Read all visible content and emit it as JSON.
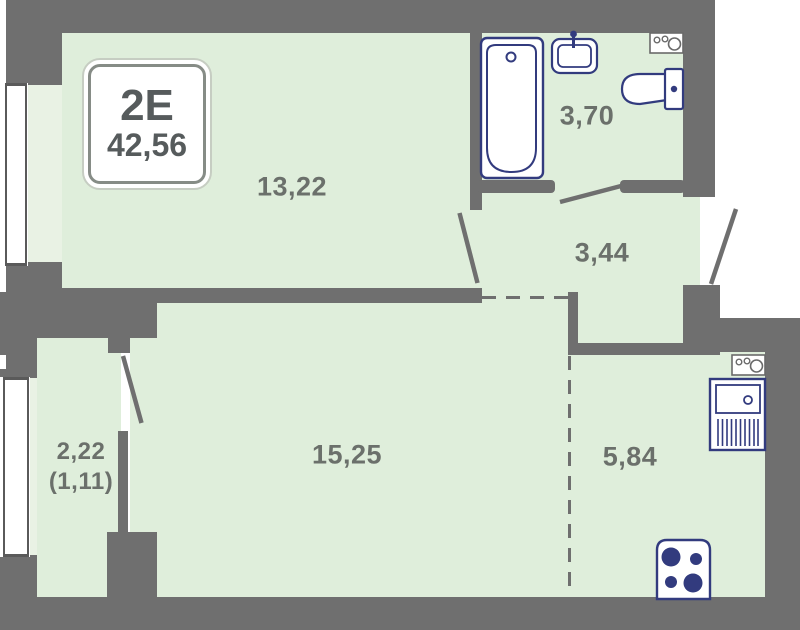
{
  "badge": {
    "unit_type": "2Е",
    "total_area": "42,56"
  },
  "rooms": {
    "room1322": {
      "name": "room",
      "area_label": "13,22"
    },
    "bathroom": {
      "name": "bathroom",
      "area_label": "3,70"
    },
    "hallway": {
      "name": "hallway",
      "area_label": "3,44"
    },
    "balcony": {
      "name": "balcony",
      "area_label": "2,22",
      "area_label_secondary": "(1,11)"
    },
    "living": {
      "name": "living-room",
      "area_label": "15,25"
    },
    "kitchen": {
      "name": "kitchen-niche",
      "area_label": "5,84"
    }
  },
  "icons": {
    "bathtub": "bathtub-icon",
    "washbasin": "washbasin-icon",
    "toilet": "toilet-icon",
    "water_heater_bathroom": "water-heater-icon",
    "water_heater_kitchen": "water-heater-icon",
    "kitchen_sink": "kitchen-sink-icon",
    "stove": "stove-icon",
    "windows": "window-icon",
    "door_swings": "door-swing-icon"
  },
  "colors": {
    "wall": "#6f6f6f",
    "floor": "#dfeedb",
    "floor_light": "#e9f2e4",
    "fixture": "#323b7e",
    "label": "#6b706b",
    "badge_text": "#565b5c"
  }
}
